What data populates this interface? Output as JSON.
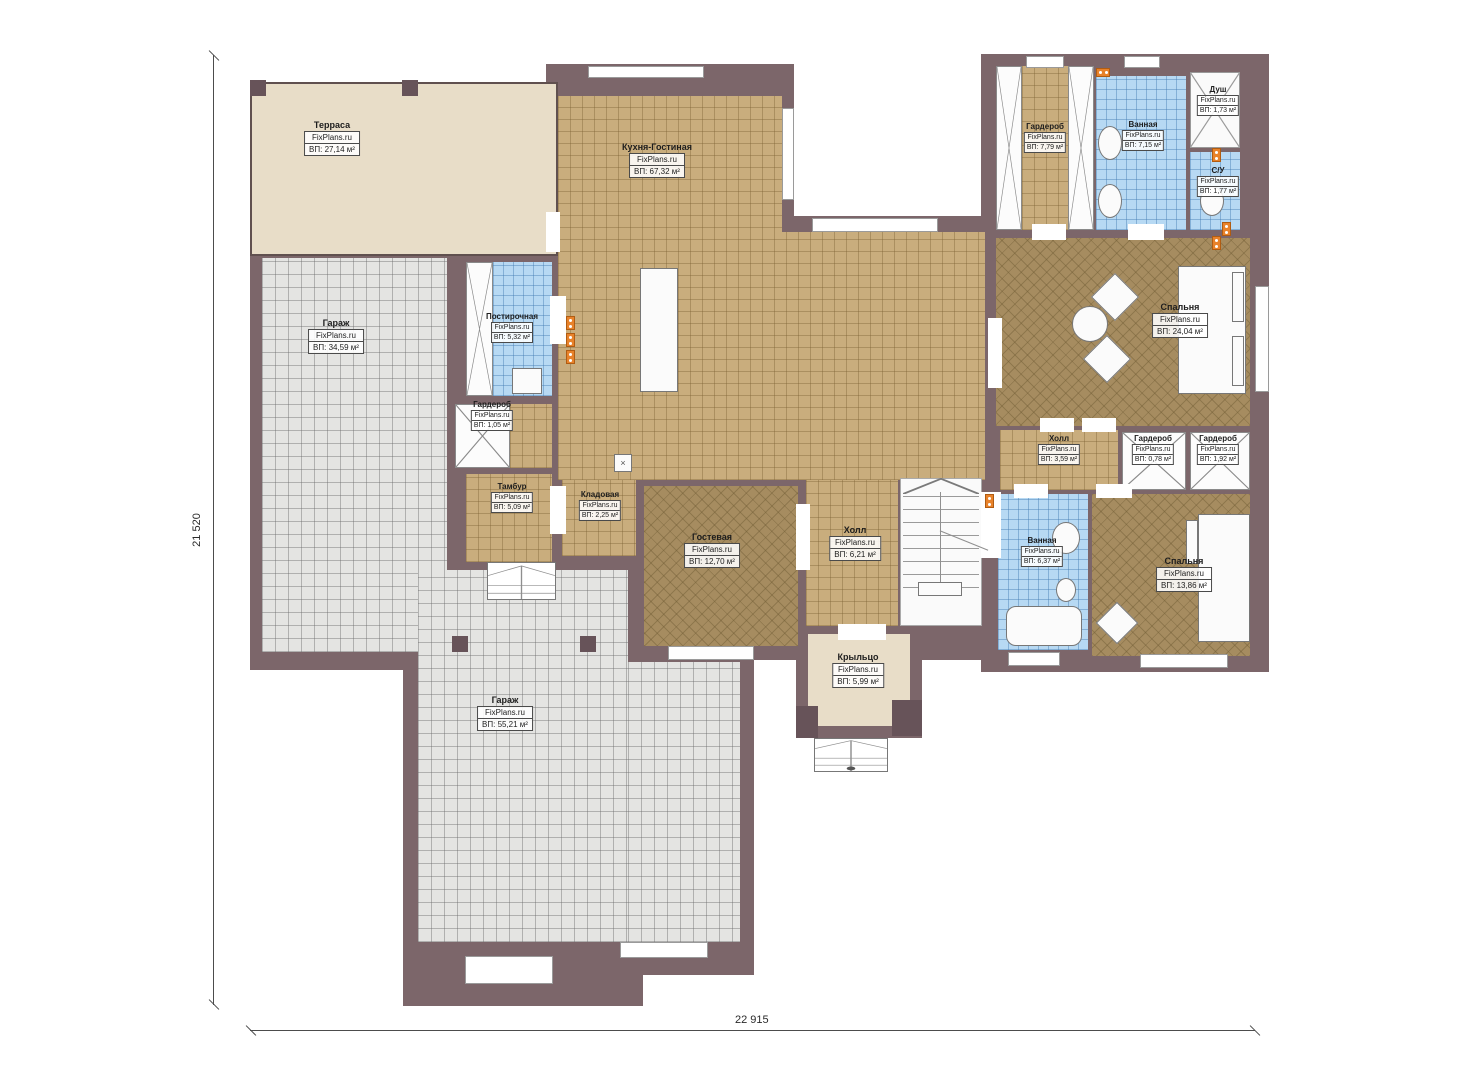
{
  "brand": "FixPlans.ru",
  "dimensions": {
    "bottom_label": "22 915",
    "left_label": "21 520"
  },
  "colors": {
    "wall": "#7c666a",
    "tile_tan": "#c9ad7d",
    "tile_grey": "#e4e4e2",
    "tile_blue": "#b7d9f3",
    "tile_dark_tan": "#a68c60",
    "terrace_beige": "#e8ddc8",
    "outlet_orange": "#e8822a"
  },
  "rooms": [
    {
      "id": "terrace",
      "name": "Терраса",
      "area": "ВП: 27,14 м²"
    },
    {
      "id": "kitchen",
      "name": "Кухня-Гостиная",
      "area": "ВП: 67,32 м²"
    },
    {
      "id": "garage1",
      "name": "Гараж",
      "area": "ВП: 34,59 м²"
    },
    {
      "id": "laundry",
      "name": "Постирочная",
      "area": "ВП: 5,32 м²"
    },
    {
      "id": "wardrobe105",
      "name": "Гардероб",
      "area": "ВП: 1,05 м²"
    },
    {
      "id": "tambour",
      "name": "Тамбур",
      "area": "ВП: 5,09 м²"
    },
    {
      "id": "pantry",
      "name": "Кладовая",
      "area": "ВП: 2,25 м²"
    },
    {
      "id": "guestroom",
      "name": "Гостевая",
      "area": "ВП: 12,70 м²"
    },
    {
      "id": "hall621",
      "name": "Холл",
      "area": "ВП: 6,21 м²"
    },
    {
      "id": "porch",
      "name": "Крыльцо",
      "area": "ВП: 5,99 м²"
    },
    {
      "id": "garage2",
      "name": "Гараж",
      "area": "ВП: 55,21 м²"
    },
    {
      "id": "wardrobe779",
      "name": "Гардероб",
      "area": "ВП: 7,79 м²"
    },
    {
      "id": "bathroom715",
      "name": "Ванная",
      "area": "ВП: 7,15 м²"
    },
    {
      "id": "shower",
      "name": "Душ",
      "area": "ВП: 1,73 м²"
    },
    {
      "id": "wc",
      "name": "С/У",
      "area": "ВП: 1,77 м²"
    },
    {
      "id": "bedroom24",
      "name": "Спальня",
      "area": "ВП: 24,04 м²"
    },
    {
      "id": "hall359",
      "name": "Холл",
      "area": "ВП: 3,59 м²"
    },
    {
      "id": "wardrobe078",
      "name": "Гардероб",
      "area": "ВП: 0,78 м²"
    },
    {
      "id": "wardrobe192",
      "name": "Гардероб",
      "area": "ВП: 1,92 м²"
    },
    {
      "id": "bathroom637",
      "name": "Ванная",
      "area": "ВП: 6,37 м²"
    },
    {
      "id": "bedroom1386",
      "name": "Спальня",
      "area": "ВП: 13,86 м²"
    }
  ]
}
